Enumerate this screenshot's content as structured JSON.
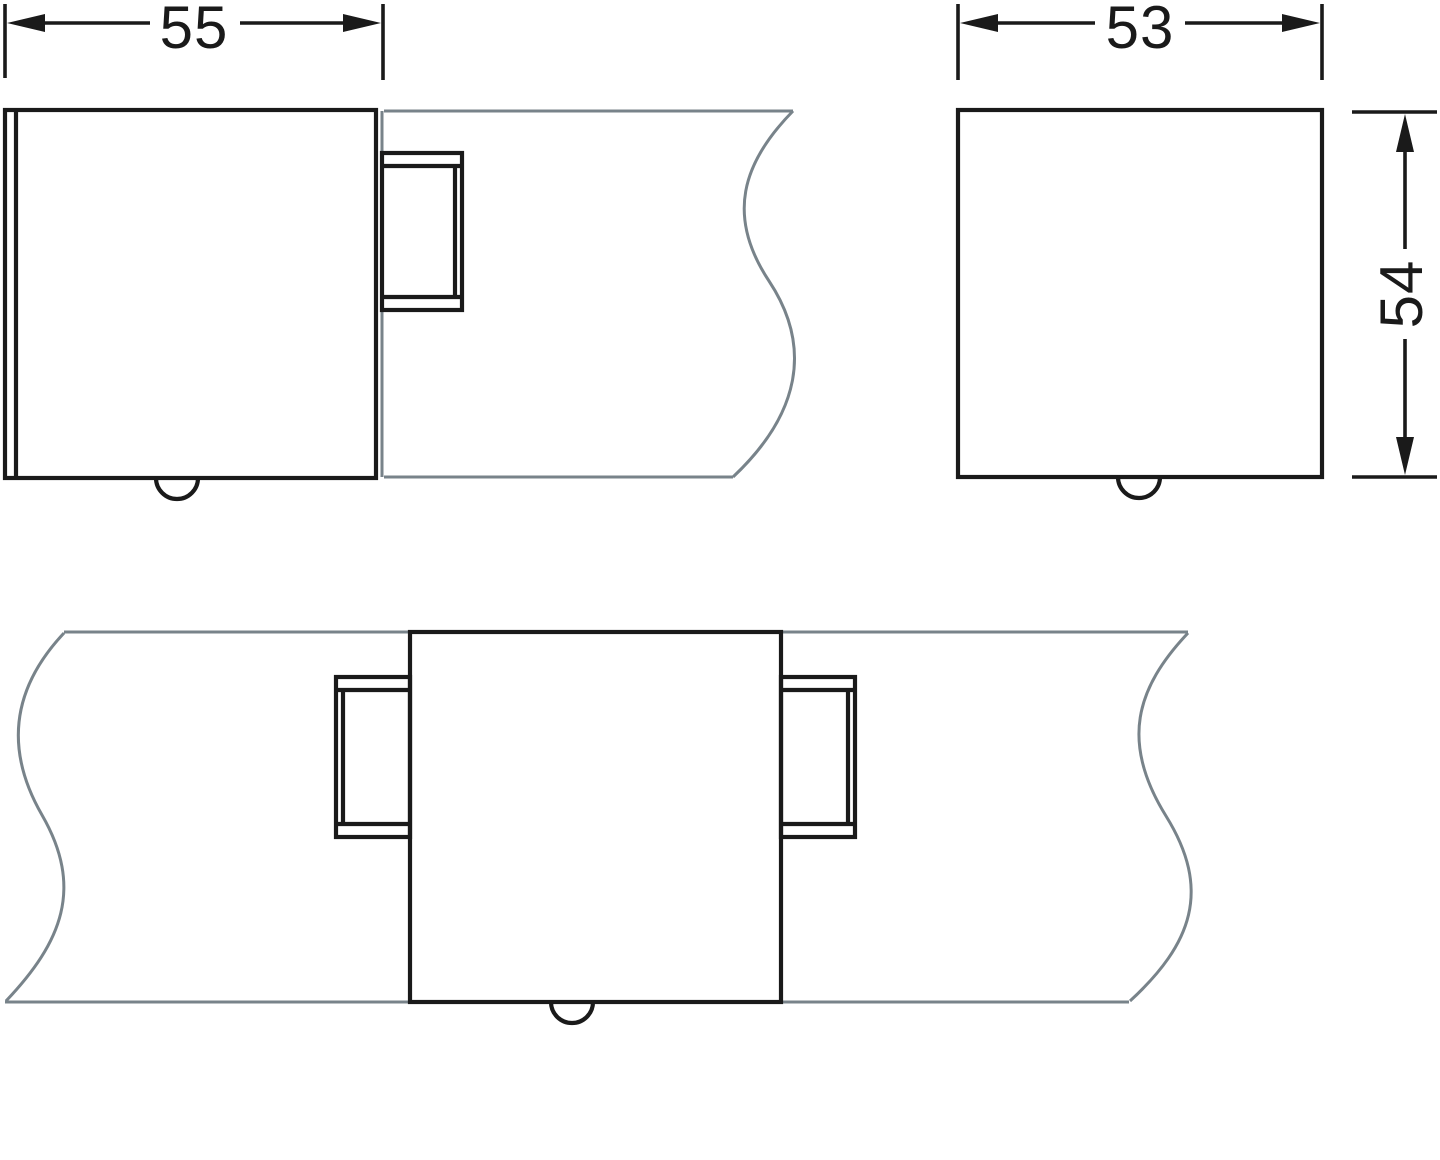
{
  "document": {
    "kind": "technical dimension drawing",
    "background": "#ffffff",
    "line_color": "#1a1a1a",
    "panel_line_color": "#78838a"
  },
  "views": {
    "side": {
      "name": "side elevation with glass panel",
      "dim_width": {
        "label": "55"
      }
    },
    "front": {
      "name": "front elevation",
      "dim_width": {
        "label": "53"
      },
      "dim_height": {
        "label": "54"
      }
    },
    "plan": {
      "name": "plan view with through panel"
    }
  }
}
